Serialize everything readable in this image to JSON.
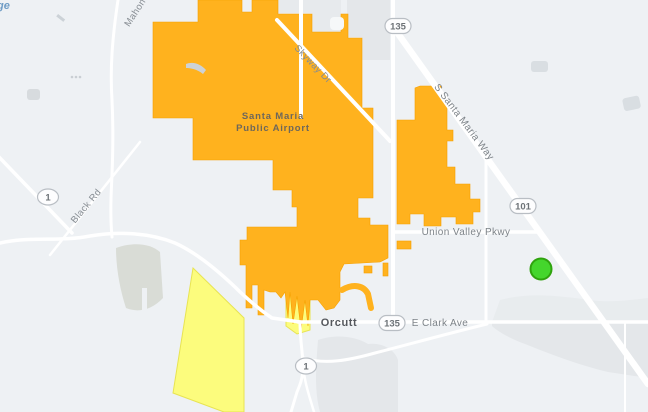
{
  "map": {
    "description": "Street map of Santa Maria Public Airport and Orcutt area with evacuation-style zones",
    "labels": {
      "airport_line1": "Santa Maria",
      "airport_line2": "Public Airport",
      "town_orcutt": "Orcutt",
      "e_clark_ave": "E Clark Ave",
      "union_valley_pkwy": "Union Valley Pkwy",
      "skyway_dr": "Skyway Dr",
      "s_santa_maria_way": "S Santa Maria Way",
      "black_rd": "Black Rd",
      "mahoney_rd": "Mahoney",
      "water_partial": "ge"
    },
    "shields": {
      "hwy_135": "135",
      "hwy_1": "1",
      "hwy_101": "101"
    },
    "zones": {
      "warning_zone": "orange zone over Santa Maria Public Airport",
      "advisory_zone": "yellow zone southwest of Orcutt"
    },
    "marker": {
      "shape": "circle",
      "meaning": "incident-location"
    },
    "colors": {
      "background": "#eef1f4",
      "zone_warning": "#FFB21E",
      "zone_warning_border": "#F5A000",
      "zone_advisory": "#FCFC7D",
      "zone_advisory_border": "#E8E452",
      "road": "#FFFFFF",
      "urban": "#E4E7EA",
      "marker_fill": "#44D62C",
      "marker_border": "#2FA30D",
      "label": "#878D93"
    }
  }
}
